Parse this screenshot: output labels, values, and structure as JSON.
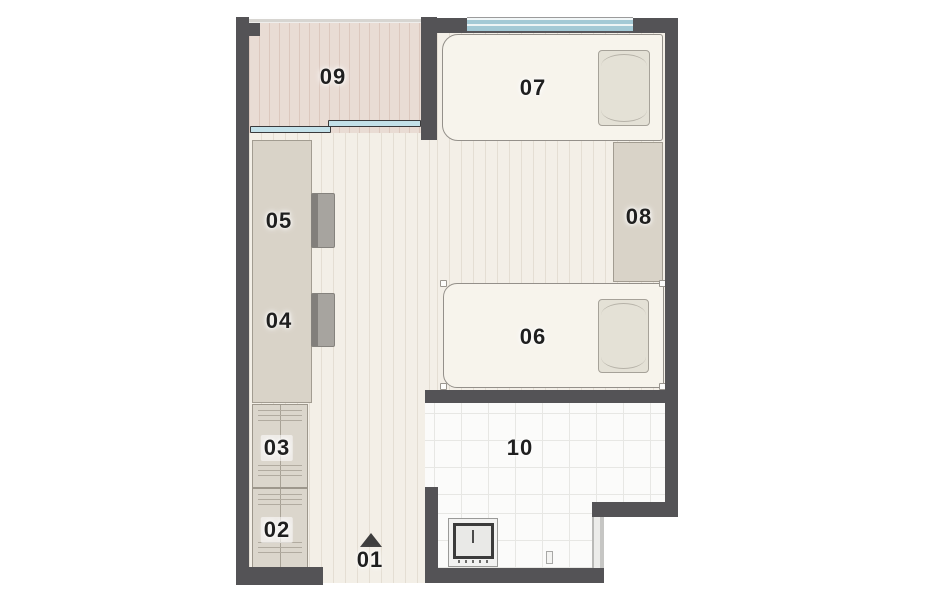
{
  "title": "apartment-floor-plan",
  "rooms": [
    {
      "id": "01",
      "label": "01"
    },
    {
      "id": "02",
      "label": "02"
    },
    {
      "id": "03",
      "label": "03"
    },
    {
      "id": "04",
      "label": "04"
    },
    {
      "id": "05",
      "label": "05"
    },
    {
      "id": "06",
      "label": "06"
    },
    {
      "id": "07",
      "label": "07"
    },
    {
      "id": "08",
      "label": "08"
    },
    {
      "id": "09",
      "label": "09"
    },
    {
      "id": "10",
      "label": "10"
    }
  ],
  "icons": {
    "entry_arrow": "entry-direction-arrow"
  },
  "colors": {
    "wall": "#545356",
    "floor": "#f3efe7",
    "balcony_floor": "#e9dcd4",
    "furniture": "#d9d3c8",
    "bed": "#f7f4ec",
    "tile": "#fbfbfa",
    "window_glass": "#a3c9d5"
  }
}
